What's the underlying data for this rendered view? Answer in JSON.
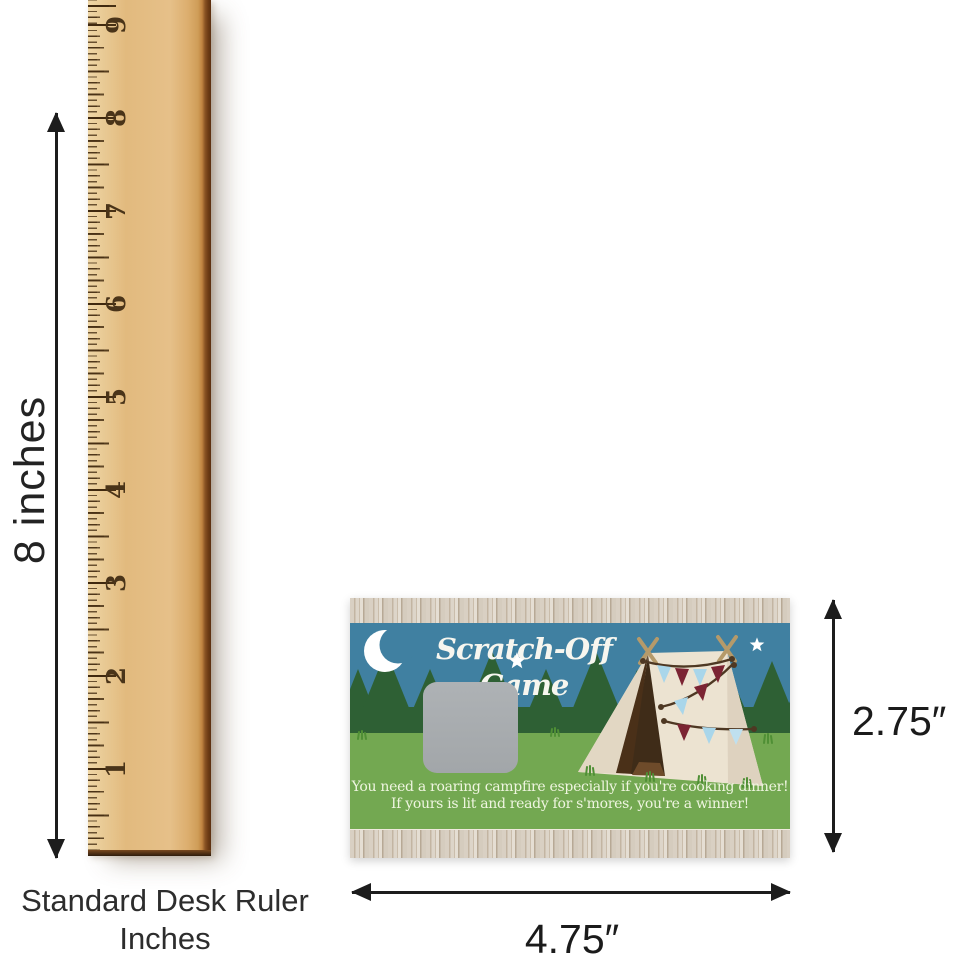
{
  "ruler": {
    "numbers": [
      "9",
      "8",
      "7",
      "6",
      "5",
      "4",
      "3",
      "2",
      "1"
    ],
    "caption_line1": "Standard Desk Ruler",
    "caption_line2": "Inches"
  },
  "dimensions": {
    "ruler_height_label": "8 inches",
    "card_height_label": "2.75″",
    "card_width_label": "4.75″"
  },
  "card": {
    "title": "Scratch-Off Game",
    "message_line1": "You need a roaring campfire especially if you're cooking dinner!",
    "message_line2": "If yours is lit and ready for s'mores, you're a winner!"
  },
  "colors": {
    "sky_blue": "#4080a1",
    "tree_green": "#2e6034",
    "grass_green": "#73a851",
    "scratch_gray": "#a8acae",
    "tent_cream": "#ece3d1",
    "pennant_blue": "#a9d6ea",
    "pennant_maroon": "#7b2433",
    "woodgrain_border": "#d8cfc2",
    "ruler_wood": "#e2ba80",
    "arrow_black": "#1c1c1c"
  }
}
